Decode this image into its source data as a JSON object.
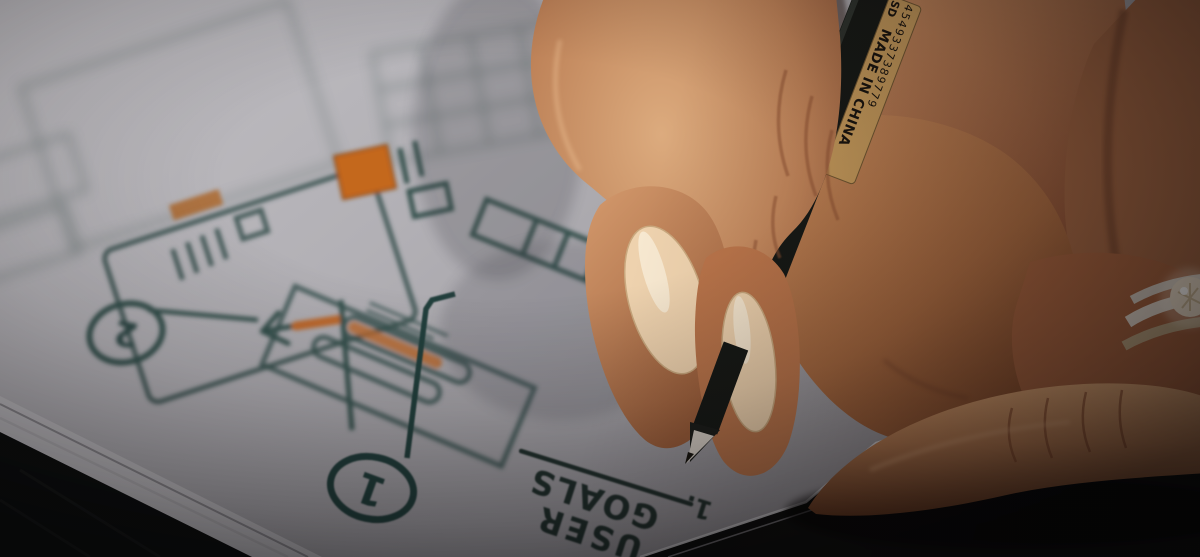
{
  "scene": {
    "description": "close-up photo: hand holding a black fineliner pen, sketching app wireframe flowcharts on gray paper over a dark table",
    "paper_color": "#b2b0b5",
    "table_color": "#0b0d0c",
    "ink_color": "#2e4a46",
    "accent_color": "#c4671f",
    "skin_color": "#b97b52",
    "nail_polish_color": "#eed2ae"
  },
  "pen": {
    "body_color": "#151815",
    "label_bg": "#c09659",
    "label_text": "MADE IN CHINA",
    "label_code": "4549337389779",
    "label_mark": "SD"
  },
  "notes": {
    "heading_line1": "USER",
    "heading_line2": "GOALS",
    "list_marker": "1.",
    "step_bottom": "1",
    "step_left": "2"
  }
}
